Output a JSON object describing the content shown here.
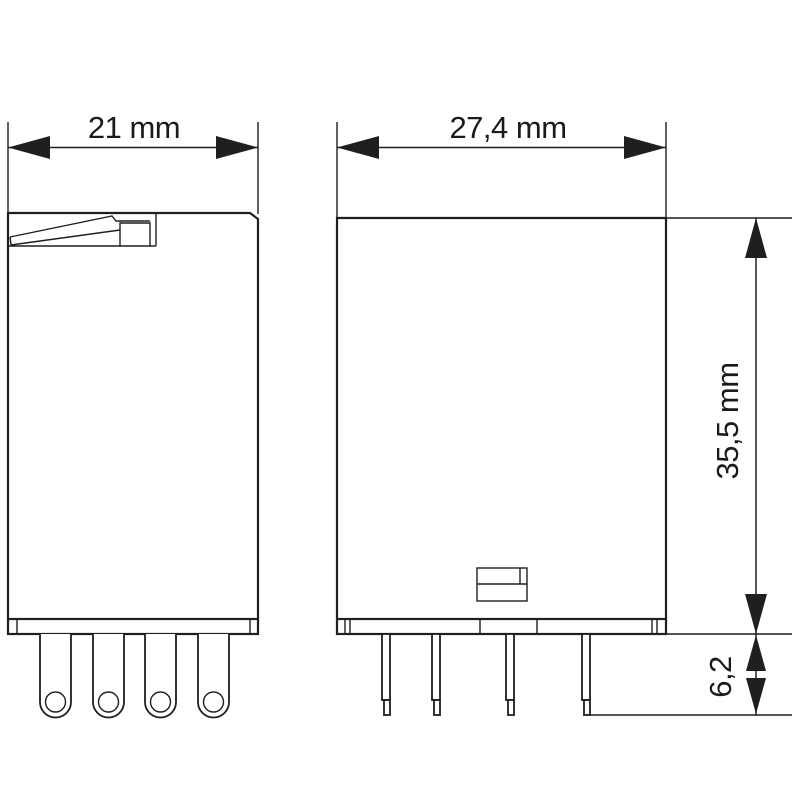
{
  "drawing": {
    "type": "relay-technical-dimension-drawing",
    "background": "#ffffff",
    "line_color": "#1f1f1f",
    "text_color": "#1a1a1a",
    "views": {
      "front": {
        "pin_count": 4
      },
      "side": {
        "pin_count": 4
      }
    },
    "dimensions": {
      "front_width": "21 mm",
      "side_width": "27,4 mm",
      "body_height": "35,5 mm",
      "pin_length": "6,2"
    }
  }
}
